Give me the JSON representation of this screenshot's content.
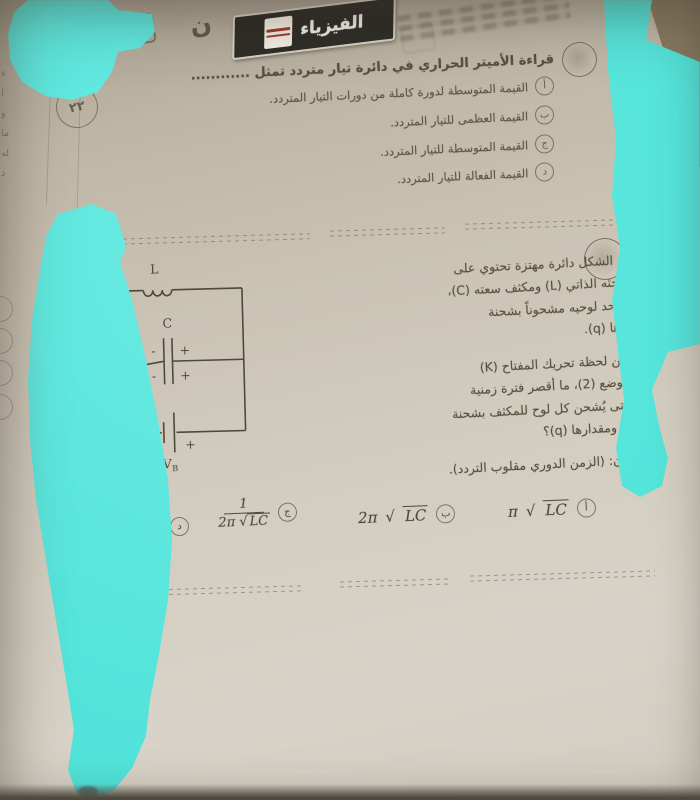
{
  "page": {
    "header": {
      "subject": "الفيزياء",
      "edition_logo": "ن",
      "series_fragment": "المذ",
      "number_fragment": "٢٨"
    },
    "margin": {
      "page_number": "٢٢",
      "edge_fragments": "ة\nا\nو\nما\nله\nد"
    },
    "q1": {
      "stem": "قراءة الأميتر الحراري في دائرة تيار متردد تمثل ............",
      "options": [
        {
          "letter": "أ",
          "text": "القيمة المتوسطة لدورة كاملة من دورات التيار المتردد."
        },
        {
          "letter": "ب",
          "text": "القيمة العظمى للتيار المتردد."
        },
        {
          "letter": "ج",
          "text": "القيمة المتوسطة للتيار المتردد."
        },
        {
          "letter": "د",
          "text": "القيمة الفعالة للتيار المتردد."
        }
      ]
    },
    "q2": {
      "para1": "يوضح الشكل دائرة مهتزة تحتوي على\nملف حثه الذاتي (L) ومكثف سعته (C)،\nوكان أحد لوحيه مشحوناً بشحنة\nمقدارها (q).",
      "para2": "بدءاً من لحظة تحريك المفتاح (K)\nإلى الوضع (2)، ما أقصر فترة زمنية\nتمر حتى يُشحن كل لوح للمكثف بشحنة\nمضادة ومقدارها (q)؟",
      "para3": "علماً بأن: (الزمن الدوري مقلوب التردد).",
      "circuit": {
        "inductor": "L",
        "capacitor": "C",
        "switch": "K",
        "battery": "V",
        "battery_sub": "B",
        "plus": "+",
        "minus": "-"
      },
      "choices": [
        {
          "letter": "د",
          "formula": "π LC"
        },
        {
          "letter": "ج",
          "num": "1",
          "den_pre": "2π",
          "radicand": "LC"
        },
        {
          "letter": "ب",
          "pre": "2π",
          "radicand": "LC"
        },
        {
          "letter": "أ",
          "pre": "π",
          "radicand": "LC"
        }
      ]
    },
    "colors": {
      "marker": "#58e7de",
      "page": "#cdc6b8",
      "ink": "#57503f"
    }
  }
}
